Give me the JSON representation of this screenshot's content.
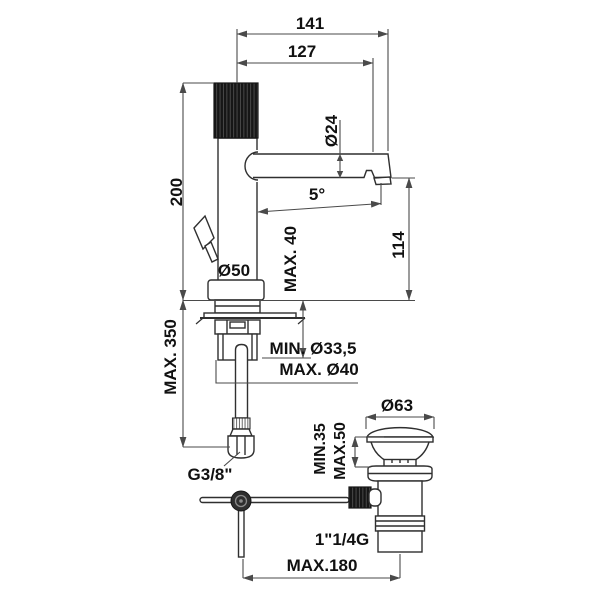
{
  "colors": {
    "background": "#ffffff",
    "line": "#2f2f2f",
    "dim_line": "#4a4a4a",
    "text": "#111111",
    "dark_fill": "#161616"
  },
  "labels": {
    "d141": "141",
    "d127": "127",
    "d24": "Ø24",
    "d200": "200",
    "angle5": "5°",
    "d114": "114",
    "d50": "Ø50",
    "max40": "MAX. 40",
    "max350": "MAX. 350",
    "hole_min": "MIN. Ø33,5",
    "hole_max": "MAX. Ø40",
    "supply_thread": "G3/8\"",
    "d63": "Ø63",
    "basin_min": "MIN.35",
    "basin_max": "MAX.50",
    "drain_thread": "1\"1/4G",
    "max180": "MAX.180"
  }
}
